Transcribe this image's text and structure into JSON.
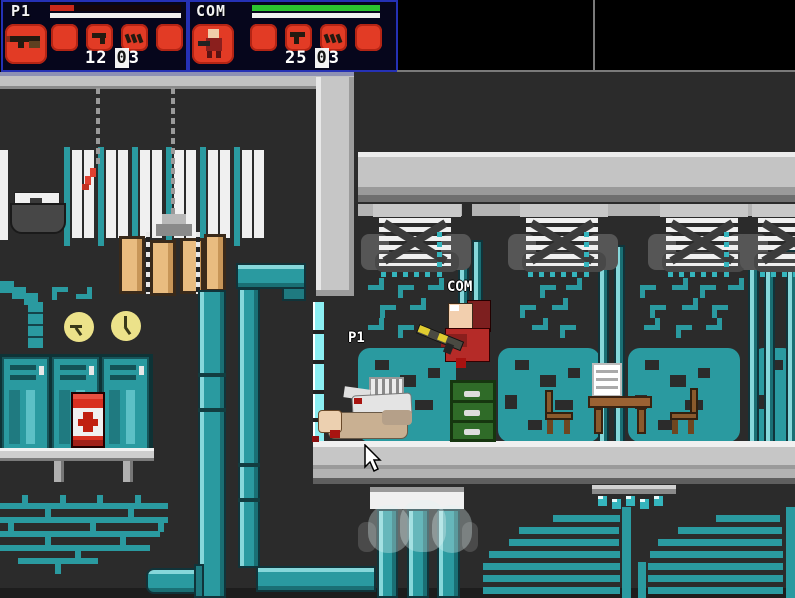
{
  "hud": {
    "p1": {
      "label": "P1",
      "health_pct": 18,
      "health_color": "#c9281a",
      "stamina_full": true,
      "ammo_clip": "12",
      "ammo_reserve": "03",
      "slots": [
        "rifle",
        "empty",
        "pistol",
        "ammo-pack",
        "empty"
      ]
    },
    "com": {
      "label": "COM",
      "health_pct": 100,
      "health_color": "#2bc32f",
      "stamina_full": true,
      "ammo_clip": "25",
      "ammo_reserve": "03",
      "slots": [
        "fighter-portrait",
        "empty",
        "uzi",
        "ammo-pack",
        "empty"
      ]
    }
  },
  "world": {
    "com_label": "COM",
    "p1_label": "P1"
  },
  "colors": {
    "teal": "#2a9aa0",
    "teal_light": "#86d7da",
    "teal_dark": "#17666b",
    "hud_slot_red": "#e23b25",
    "hud_border_blue": "#2531b5",
    "background": "#2b2b2b",
    "floor_gray": "#c6c6c6",
    "barrel_red": "#d83020",
    "cabinet_green": "#2f6b28",
    "wood_brown": "#8a5a2c"
  }
}
